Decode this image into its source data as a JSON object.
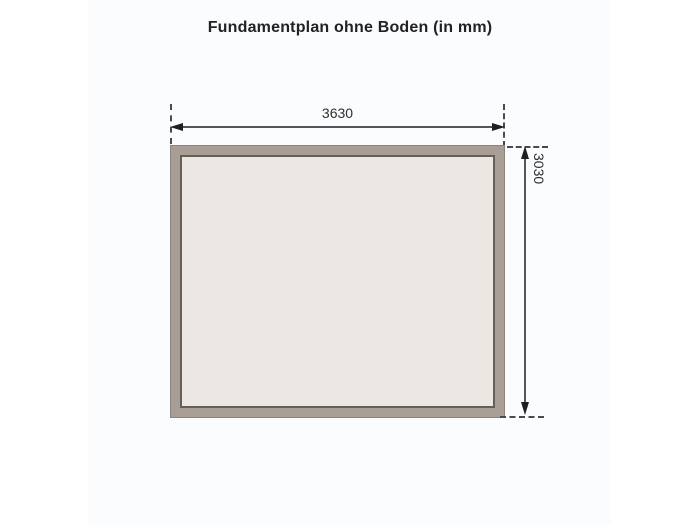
{
  "title": "Fundamentplan ohne Boden (in mm)",
  "diagram": {
    "type": "foundation-plan",
    "unit": "mm",
    "width_dimension": {
      "label": "3630"
    },
    "height_dimension": {
      "label": "3030"
    },
    "colors": {
      "frame": "#a89e95",
      "frame_edge": "#8d847c",
      "inner_edge": "#665f58",
      "inner_fill": "#ebe7e2",
      "dimension_line": "#4f565c",
      "extension_line": "#4a4a4a",
      "arrowhead": "#1f1f1f",
      "label_text": "#2e2e2e",
      "title_text": "#222222",
      "canvas_tint": "#fbfcfe",
      "background": "#ffffff"
    }
  }
}
